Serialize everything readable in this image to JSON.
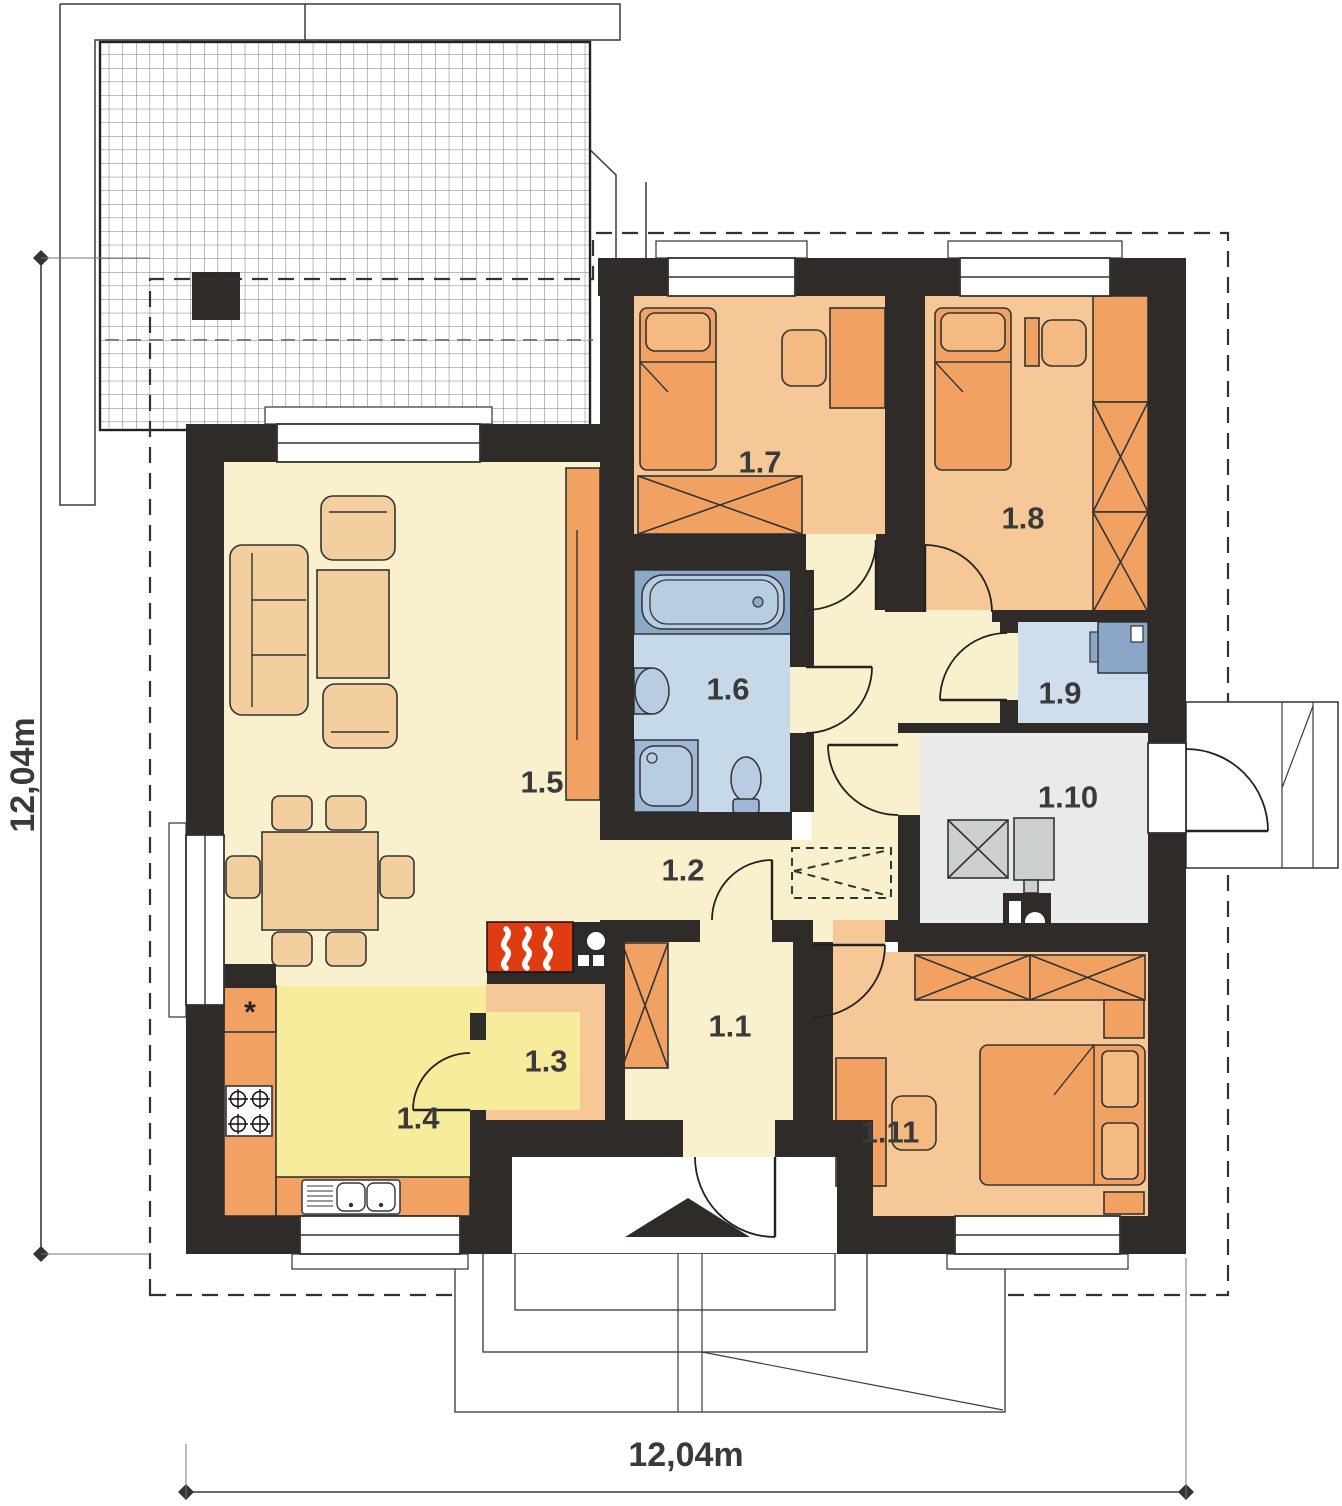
{
  "title": "single-storey house floor plan",
  "dims": {
    "bottom": "12,04m",
    "left": "12,04m"
  },
  "rooms": [
    {
      "label": "1.1"
    },
    {
      "label": "1.2"
    },
    {
      "label": "1.3"
    },
    {
      "label": "1.4"
    },
    {
      "label": "1.5"
    },
    {
      "label": "1.6"
    },
    {
      "label": "1.7"
    },
    {
      "label": "1.8"
    },
    {
      "label": "1.9"
    },
    {
      "label": "1.10"
    },
    {
      "label": "1.11"
    }
  ],
  "kitchen": {
    "fridge_symbol": "*"
  },
  "icons": {
    "fireplace": "flame-icon",
    "entrance": "triangle-arrow-icon",
    "attic_access": "dashed-hatch-box-icon",
    "stove": "four-burner-icon",
    "sink": "double-sink-icon",
    "bathtub": "bathtub-icon",
    "washbasin": "washbasin-icon",
    "shower": "shower-icon",
    "toilet": "toilet-icon",
    "boiler": "boiler-icon",
    "chimney": "chimney-icon"
  },
  "colors": {
    "wall": "#2e2b28",
    "floor_cream": "#f9f1cd",
    "floor_yellow": "#f6ec9c",
    "floor_orange": "#f7c897",
    "floor_blue": "#c6d9e9",
    "floor_blue_light": "#cfdeec",
    "floor_gray": "#e9eaea",
    "furn_orange": "#f1a263",
    "furn_light": "#f5ba82",
    "furn_beige": "#f3cf9f",
    "fixture_blue": "#9db7d6",
    "fixture_blue_light": "#b9cde2",
    "tub_bg": "#8ca8c8",
    "equip_gray": "#cdd0d1",
    "desk_blue": "#8ba6c6",
    "fireplace_red": "#e03c12",
    "line": "#333333",
    "label": "#3a3a3a",
    "roofline": "#3c3c3c",
    "grid": "#808080"
  }
}
